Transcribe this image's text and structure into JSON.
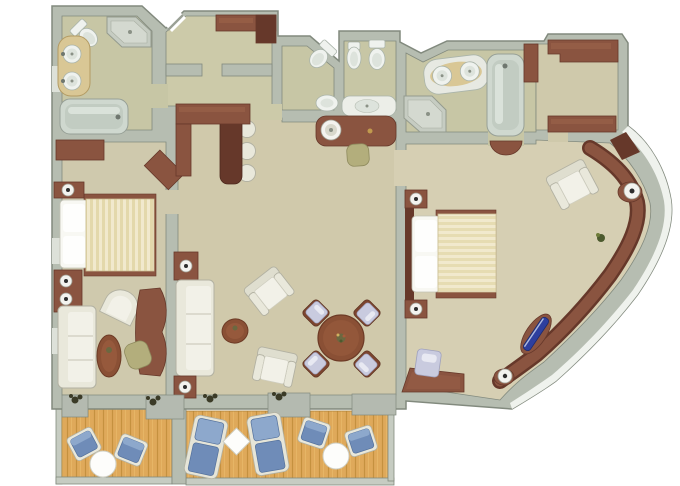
{
  "title": "suite-floor-plan-rendering",
  "canvas": {
    "width": 680,
    "height": 486,
    "background": "#ffffff"
  },
  "palette": {
    "wall": "#b6bdb1",
    "wall_edge": "#828a7e",
    "wall_band_white": "#eff2ed",
    "floor_bath": "#c7c6a5",
    "floor_hall": "#cccaa9",
    "floor_bed1": "#cfc9ad",
    "floor_living": "#d0c9ab",
    "floor_bed2": "#d6cfb3",
    "floor_closet": "#cfc9ab",
    "wood": "#8a5440",
    "wood_dark": "#66382a",
    "wood_light": "#9d644a",
    "table_top": "#8a5035",
    "white_furn": "#e9e8db",
    "white_furn_edge": "#b2b1a2",
    "seat_light": "#f2f1e8",
    "fixture": "#eff2ee",
    "fixture_rim": "#aab4aa",
    "fixture_inner": "#dde3dc",
    "tub": "#cfd8cf",
    "tub_inner": "#c2ccc2",
    "tub_hilite": "#dae2da",
    "counter_tan": "#d9c795",
    "counter_tan_edge": "#b39b63",
    "shower": "#c6ccc2",
    "shower_inner": "#d4d9d0",
    "deck": "#dfa95a",
    "deck_line": "#c5913f",
    "rail": "#c6ccc2",
    "sill": "#b4bab0",
    "duvet_a": "#f1e9cd",
    "duvet_b": "#e3d8ab",
    "duvet_edge": "#cbbf93",
    "pillow": "#f8f8f3",
    "blue": "#6f8cb8",
    "blue_light": "#8da8cc",
    "blue_dark": "#54719c",
    "lavender": "#c9cbdf",
    "lavender_edge": "#9fa1bd",
    "olive": "#b3ae7c",
    "olive_edge": "#8e8a5d",
    "plant": "#3b3b27",
    "accent_blue": "#2e3f9e",
    "lamp": "#f3f3ef",
    "lamp_rim": "#a0a094",
    "lamp_dot": "#2e2e2e",
    "window": "#dde1d9"
  },
  "floor_plan": {
    "rooms": [
      "master-bathroom",
      "entry-hall",
      "powder-room",
      "water-closet",
      "dressing-vanity-area",
      "second-bathroom",
      "walk-in-closet",
      "master-bedroom",
      "living-room",
      "dining-area",
      "second-bedroom",
      "balcony-left",
      "balcony-right"
    ],
    "furniture": {
      "master_bathroom": [
        "toilet",
        "corner-shower",
        "twin-sink-vanity",
        "bathtub"
      ],
      "entry_hall": [
        "entry-door",
        "entry-closet"
      ],
      "powder_room": [
        "toilet",
        "sink"
      ],
      "water_closet": [
        "bidet",
        "toilet",
        "sink-counter"
      ],
      "dressing_area": [
        "vanity-counter",
        "round-basin",
        "stool"
      ],
      "second_bathroom": [
        "twin-sink-vanity",
        "bathtub",
        "corner-shower",
        "door-arc"
      ],
      "walk_in_closet": [
        "wardrobe-top",
        "wardrobe-bottom",
        "side-cabinet"
      ],
      "master_bedroom": [
        "dresser",
        "corner-tv-cabinet",
        "bed",
        "nightstands",
        "lamps",
        "barrel-chair",
        "sofa",
        "end-tables",
        "oval-coffee-table",
        "writing-desk",
        "desk-chair"
      ],
      "living_room": [
        "bar-counter",
        "bar-stools",
        "sofa",
        "end-tables",
        "lamps",
        "armchair",
        "armchair",
        "oval-coffee-table",
        "dining-table",
        "dining-chairs"
      ],
      "second_bedroom": [
        "bed",
        "nightstands",
        "lamps",
        "armchair",
        "desk",
        "desk-chair",
        "curved-built-in-cabinet",
        "cabinet-lamp",
        "blue-decor-object",
        "cabinet-knob",
        "plant"
      ],
      "balconies": [
        "deck-chairs",
        "loungers",
        "round-tables",
        "diamond-table",
        "railings",
        "door-sills",
        "planters"
      ]
    },
    "counts": {
      "bar_stools": 3,
      "dining_chairs": 4,
      "loungers": 2,
      "deck_chairs": 4,
      "deck_tables": 3,
      "balconies": 2
    }
  }
}
